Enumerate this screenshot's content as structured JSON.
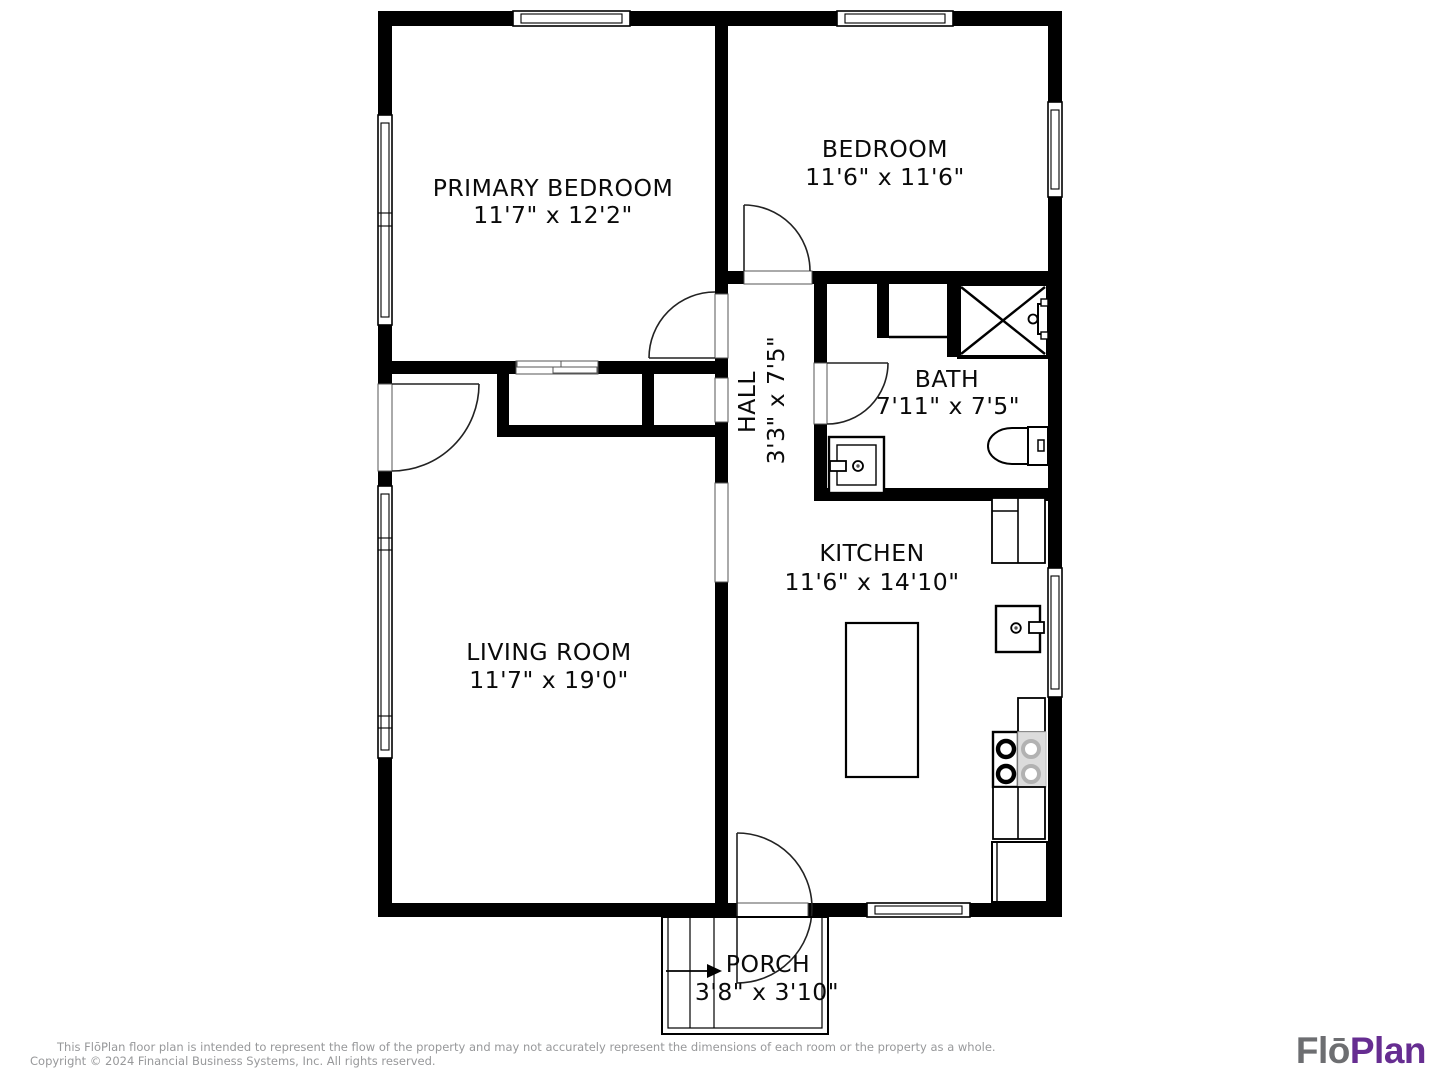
{
  "plan": {
    "rooms": {
      "primary_bedroom": {
        "name": "PRIMARY BEDROOM",
        "dims": "11'7\" x 12'2\""
      },
      "bedroom": {
        "name": "BEDROOM",
        "dims": "11'6\" x 11'6\""
      },
      "bath": {
        "name": "BATH",
        "dims": "7'11\" x 7'5\""
      },
      "hall": {
        "name": "HALL",
        "dims": "3'3\" x 7'5\""
      },
      "kitchen": {
        "name": "KITCHEN",
        "dims": "11'6\" x 14'10\""
      },
      "living_room": {
        "name": "LIVING ROOM",
        "dims": "11'7\" x 19'0\""
      },
      "porch": {
        "name": "PORCH",
        "dims": "3'8\" x 3'10\""
      }
    },
    "fixtures": [
      "shower",
      "toilet",
      "bath-vanity",
      "kitchen-sink",
      "stove",
      "refrigerator",
      "island",
      "counters",
      "porch-steps"
    ]
  },
  "footer": {
    "disclaimer_line1": "This FlōPlan floor plan is intended to represent the flow of the property and may not accurately represent the dimensions of each room or the property as a whole.",
    "disclaimer_line2": "Copyright © 2024 Financial Business Systems, Inc. All rights reserved."
  },
  "logo": {
    "part1": "Flō",
    "part2": "Plan"
  },
  "colors": {
    "wall": "#000000",
    "logo_gray": "#6d6e71",
    "logo_purple": "#662d91",
    "disclaimer_gray": "#97989a",
    "stove_gray": "#dcdcdc"
  }
}
